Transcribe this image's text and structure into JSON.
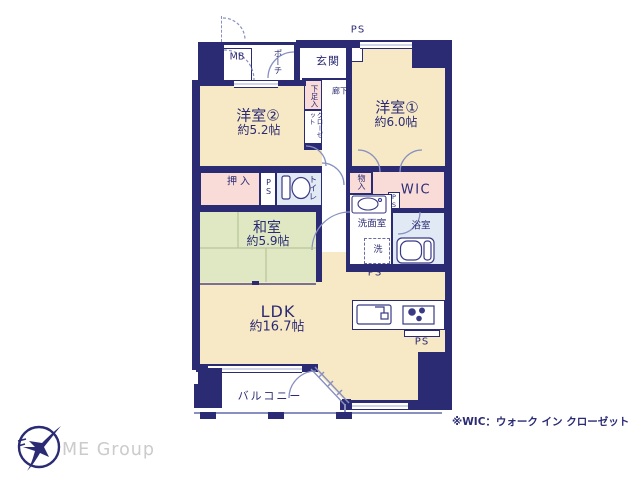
{
  "plan": {
    "rooms": {
      "western1": {
        "name": "洋室①",
        "area": "約6.0帖"
      },
      "western2": {
        "name": "洋室②",
        "area": "約5.2帖"
      },
      "japanese": {
        "name": "和室",
        "area": "約5.9帖"
      },
      "ldk": {
        "name": "LDK",
        "area": "約16.7帖"
      },
      "balcony": {
        "name": "バルコニー"
      }
    },
    "labels": {
      "entrance": "玄関",
      "hallway": "廊下",
      "porch": "ポーチ",
      "meter_box": "MB",
      "shoe_cabinet": "下足入",
      "closet": "クローゼット",
      "futon_closet": "押入",
      "toilet": "トイレ",
      "storage": "物入",
      "wic": "WIC",
      "washroom": "洗面室",
      "bathroom": "浴室",
      "washing_machine": "洗",
      "pipe_space": "PS"
    },
    "note": "※WIC：ウォーク イン クローゼット"
  },
  "logo": {
    "company": "ME Group"
  },
  "colors": {
    "wall": "#2b2b74",
    "room_floor": "#f7e9c5",
    "tatami_floor": "#dfe8c3",
    "closet_pink": "#f9dcd8",
    "wet_area_blue": "#e1eaf4",
    "logo_text": "#cbcbcb"
  }
}
